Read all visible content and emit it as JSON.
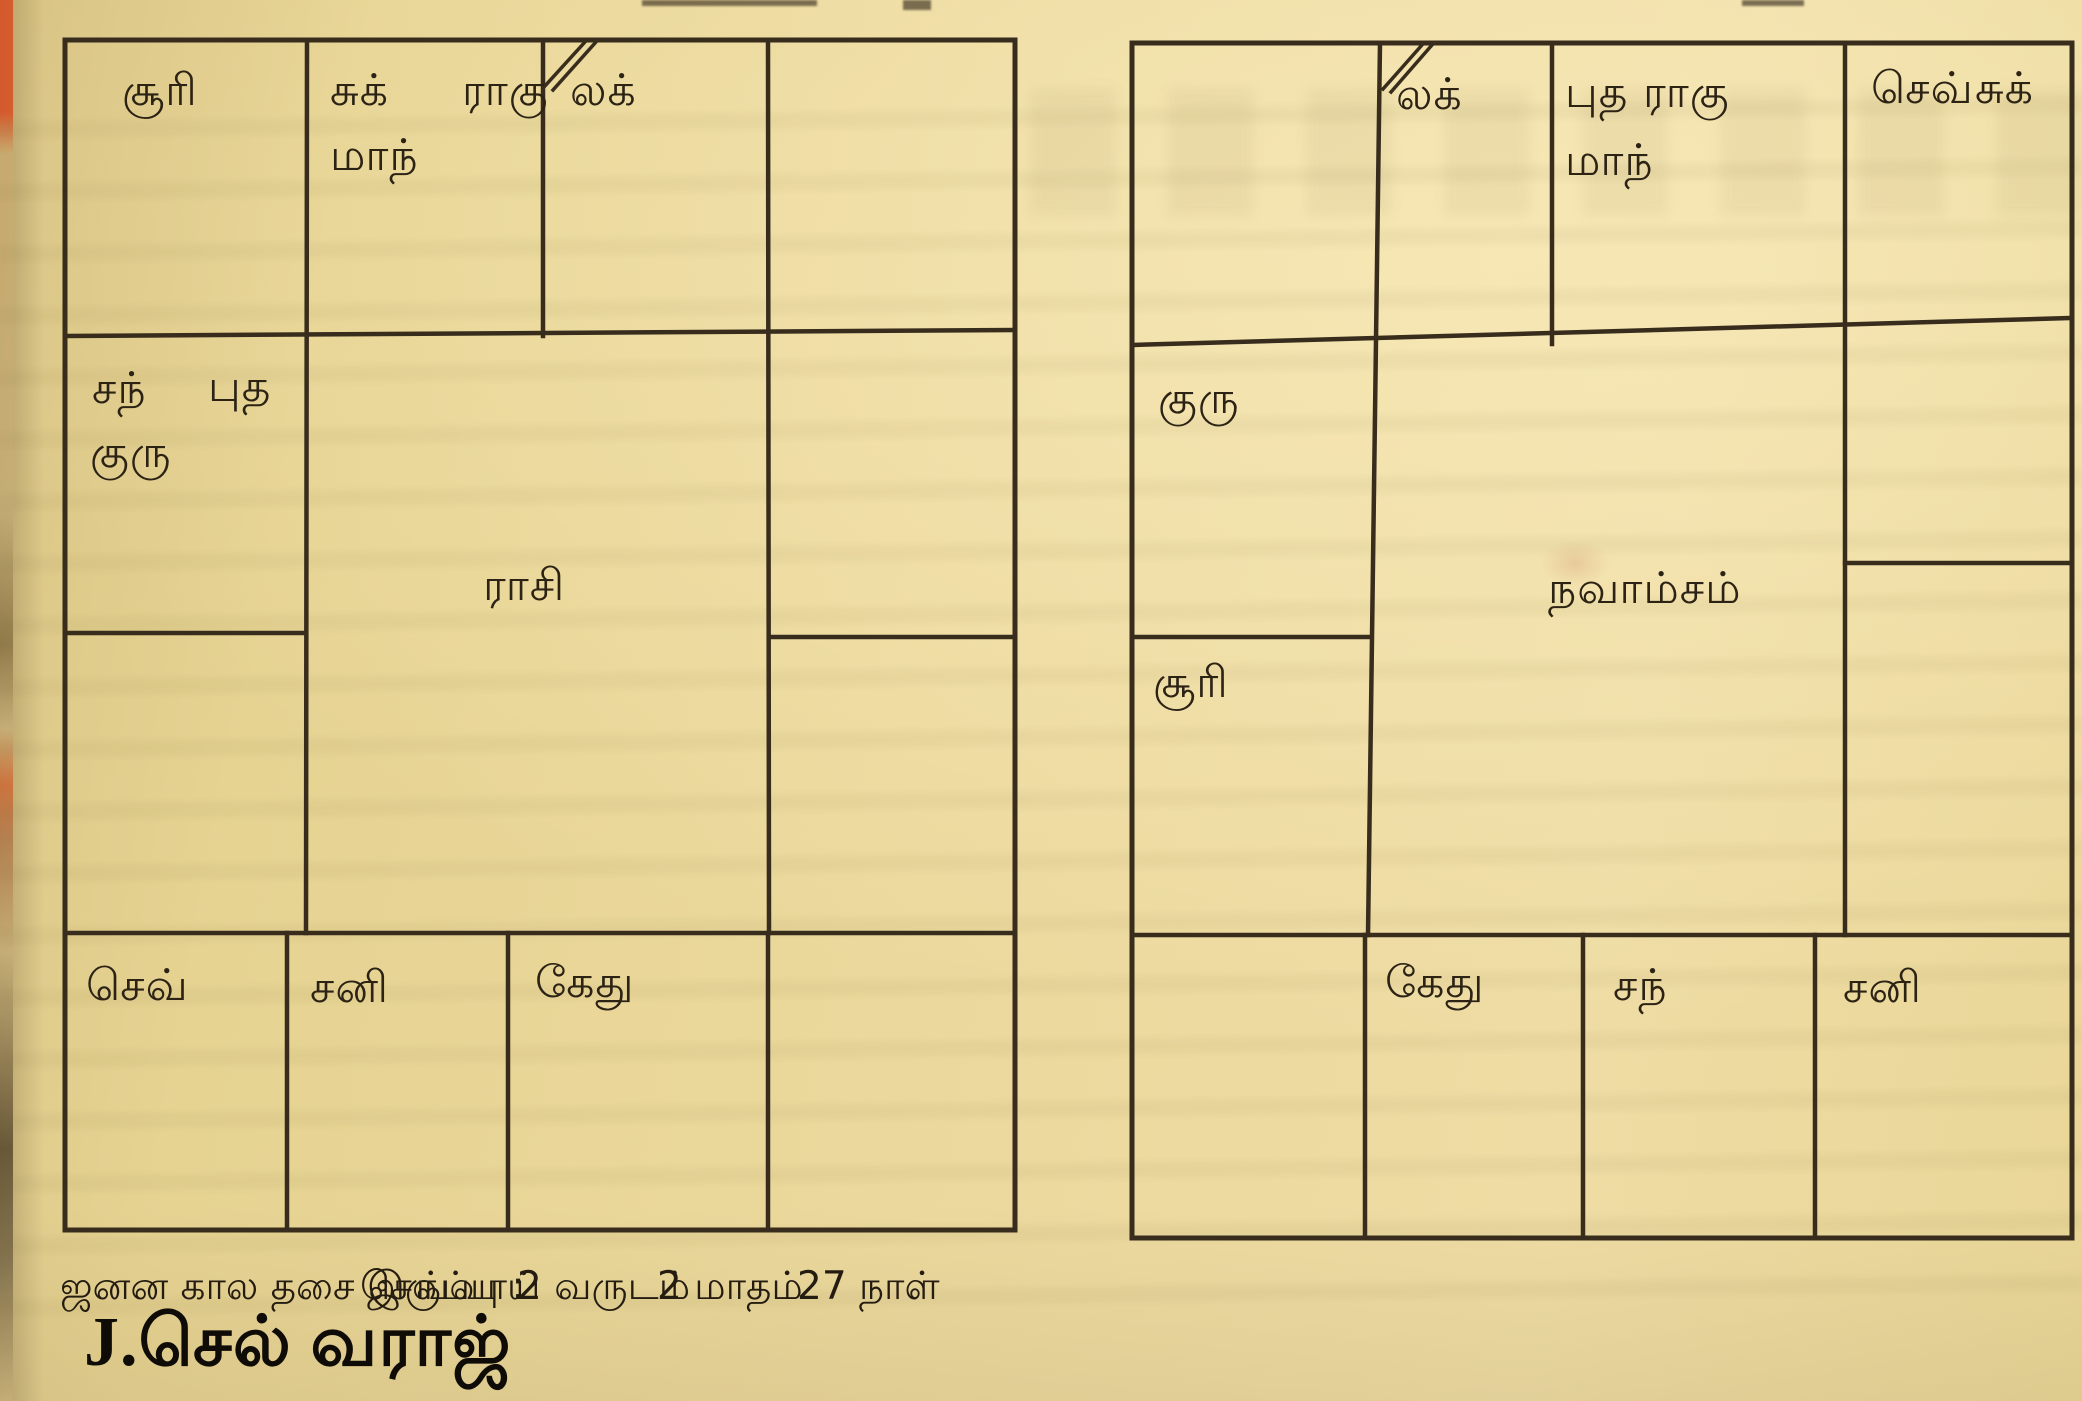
{
  "page": {
    "paper_color": "#e9d697",
    "ink_color": "#2c2315",
    "line_color": "#3a2d1d",
    "edge_red_color": "#d94e22"
  },
  "rasi": {
    "title": "ராசி",
    "p_suri": "சூரி",
    "p_suk": "சுக்",
    "p_ragu": "ராகு",
    "p_mandhi": "மாந்",
    "p_lak": "லக்",
    "p_chan": "சந்",
    "p_putha": "புத",
    "p_guru": "குரு",
    "p_sev": "செவ்",
    "p_sani": "சனி",
    "p_kethu": "கேது"
  },
  "navamsam": {
    "title": "நவாம்சம்",
    "p_lak": "லக்",
    "p_putha": "புத",
    "p_ragu": "ராகு",
    "p_mandhi": "மாந்",
    "p_sev": "செவ்",
    "p_suk": "சுக்",
    "p_guru": "குரு",
    "p_suri": "சூரி",
    "p_kethu": "கேது",
    "p_chan": "சந்",
    "p_sani": "சனி"
  },
  "footer": {
    "balance_label": "ஜனன கால தசை இருப்பு :",
    "balance_planet": "செவ்வாய்",
    "balance_years": "2 வருடம்",
    "balance_months": "2 மாதம்",
    "balance_days": "27 நாள்",
    "person_name": "J.செல் வராஜ்"
  }
}
